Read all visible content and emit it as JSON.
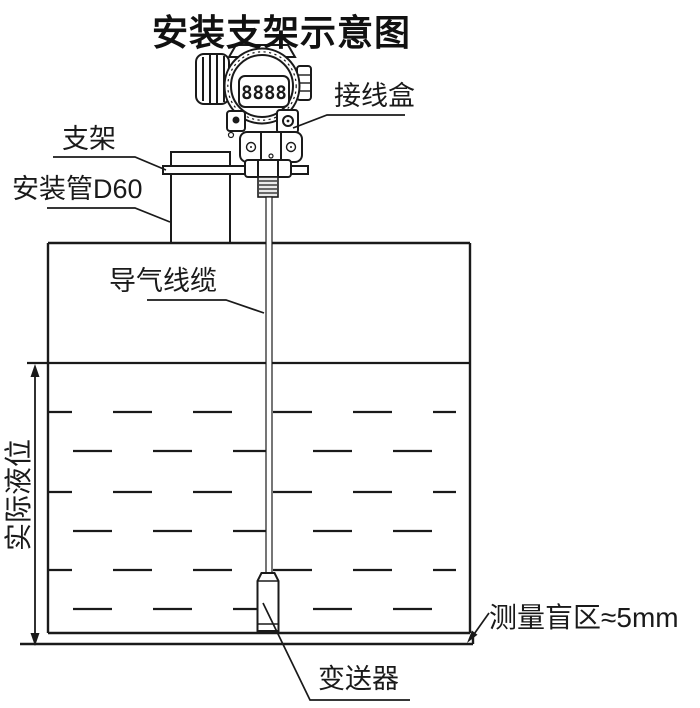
{
  "title": "安装支架示意图",
  "labels": {
    "junction_box": "接线盒",
    "bracket": "支架",
    "mounting_pipe": "安装管D60",
    "air_guide_cable": "导气线缆",
    "actual_liquid_level": "实际液位",
    "blind_zone": "测量盲区≈5mm",
    "transmitter": "变送器"
  },
  "instrument": {
    "display_value": "8888"
  },
  "colors": {
    "line": "#1a1a1a",
    "background": "#ffffff",
    "thread_fill": "#e9e9e9"
  }
}
